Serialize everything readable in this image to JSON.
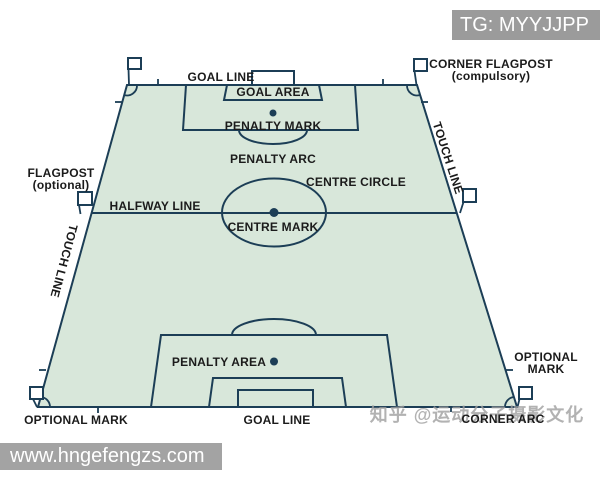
{
  "overlay": {
    "tg_badge": "TG: MYYJJPP",
    "bottom_bar_url": "www.hngefengzs.com",
    "watermark": "知乎 @运动分子摄影文化"
  },
  "diagram": {
    "labels": {
      "goal_line_top": "GOAL LINE",
      "goal_area": "GOAL AREA",
      "penalty_mark": "PENALTY MARK",
      "penalty_arc": "PENALTY ARC",
      "centre_circle": "CENTRE CIRCLE",
      "halfway_line": "HALFWAY LINE",
      "centre_mark": "CENTRE MARK",
      "touch_line_left": "TOUCH LINE",
      "touch_line_right": "TOUCH LINE",
      "flagpost_line1": "FLAGPOST",
      "flagpost_line2": "(optional)",
      "corner_flagpost_line1": "CORNER FLAGPOST",
      "corner_flagpost_line2": "(compulsory)",
      "penalty_area": "PENALTY AREA",
      "optional_mark_right_line1": "OPTIONAL",
      "optional_mark_right_line2": "MARK",
      "optional_mark_bottom": "OPTIONAL MARK",
      "goal_line_bottom": "GOAL LINE",
      "corner_arc": "CORNER ARC"
    }
  },
  "theme": {
    "field-green": "#d8e7da",
    "line-navy": "#1c3e56",
    "label-dark": "#1b1b1b",
    "badge-gray": "#9b9b9b",
    "bar-gray": "#a3a3a3",
    "watermark-gray": "#9f9f9f"
  }
}
